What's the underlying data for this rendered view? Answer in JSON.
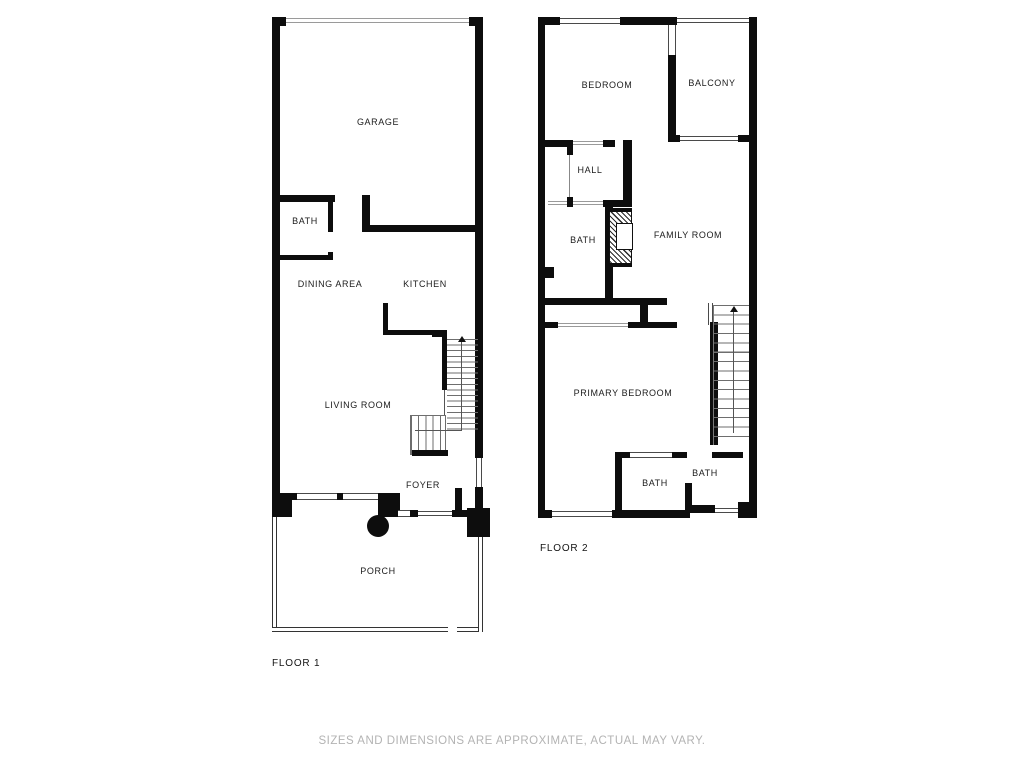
{
  "disclaimer": "SIZES AND DIMENSIONS ARE APPROXIMATE, ACTUAL MAY VARY.",
  "floor1": {
    "label": "FLOOR 1",
    "rooms": {
      "garage": "GARAGE",
      "bath": "BATH",
      "dining_area": "DINING AREA",
      "kitchen": "KITCHEN",
      "living_room": "LIVING ROOM",
      "foyer": "FOYER",
      "porch": "PORCH"
    }
  },
  "floor2": {
    "label": "FLOOR 2",
    "rooms": {
      "bedroom": "BEDROOM",
      "balcony": "BALCONY",
      "hall": "HALL",
      "bath": "BATH",
      "family_room": "FAMILY ROOM",
      "primary_bedroom": "PRIMARY BEDROOM",
      "bath_left": "BATH",
      "bath_right": "BATH"
    }
  },
  "colors": {
    "wall": "#0d0d0d",
    "thin_line": "#555555",
    "label": "#1c1c1c",
    "muted_text": "#b3b3b3",
    "background": "#ffffff"
  }
}
